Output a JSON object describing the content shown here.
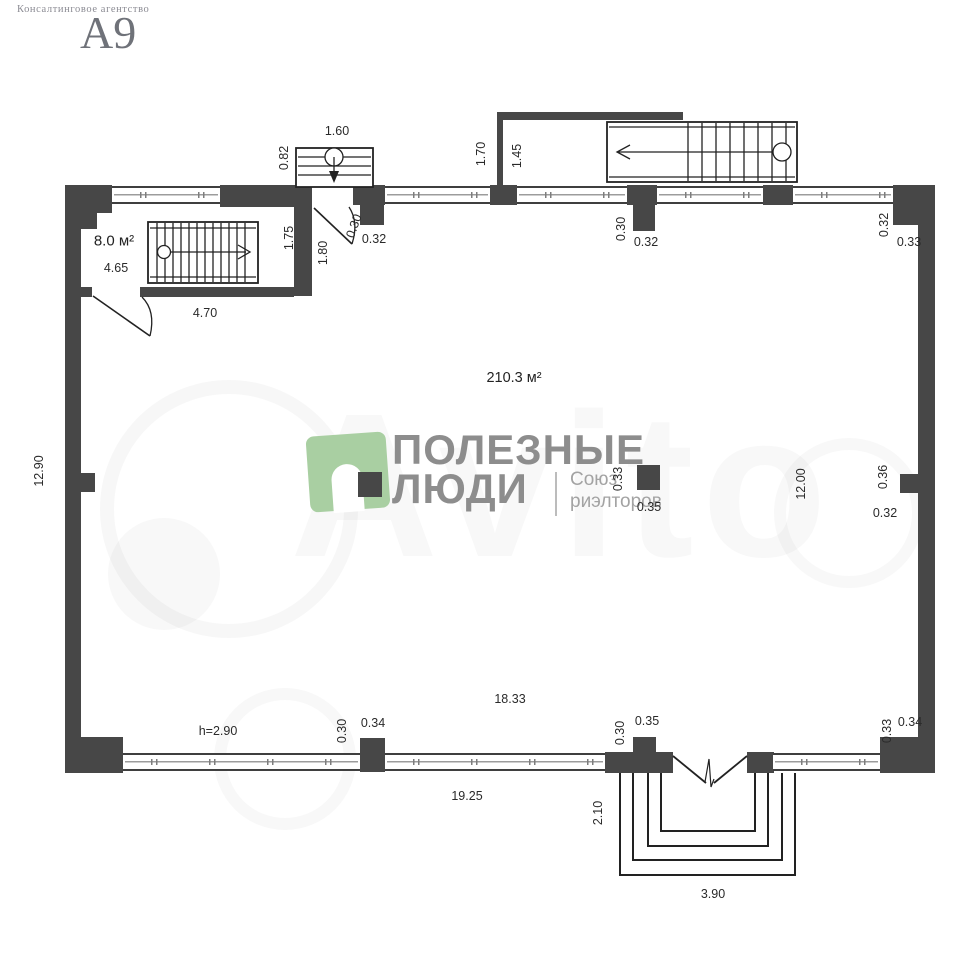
{
  "header": {
    "agency": "Консалтинговое агентство",
    "agency_code": "А9"
  },
  "watermark": {
    "text": "Avito"
  },
  "logo": {
    "title_line1": "ПОЛЕЗНЫЕ",
    "title_line2": "ЛЮДИ",
    "subtitle_line1": "Союз",
    "subtitle_line2": "риэлторов",
    "green": "#a9cfa2",
    "text_color": "#8d8d8d"
  },
  "plan": {
    "total_area": "210.3 м²",
    "room_area": "8.0 м²",
    "colors": {
      "wall": "#474747",
      "line": "#222222"
    },
    "dimensions": [
      {
        "id": "d01",
        "text": "1.60"
      },
      {
        "id": "d02",
        "text": "0.82"
      },
      {
        "id": "d03",
        "text": "1.70"
      },
      {
        "id": "d04",
        "text": "1.45"
      },
      {
        "id": "d05",
        "text": "0.30"
      },
      {
        "id": "d06",
        "text": "0.32"
      },
      {
        "id": "d07",
        "text": "0.30"
      },
      {
        "id": "d08",
        "text": "0.32"
      },
      {
        "id": "d09",
        "text": "0.32"
      },
      {
        "id": "d10",
        "text": "0.33"
      },
      {
        "id": "d11",
        "text": "4.65"
      },
      {
        "id": "d12",
        "text": "4.70"
      },
      {
        "id": "d13",
        "text": "1.75"
      },
      {
        "id": "d14",
        "text": "1.80"
      },
      {
        "id": "d15",
        "text": "12.90"
      },
      {
        "id": "d16",
        "text": "12.00"
      },
      {
        "id": "d17",
        "text": "0.36"
      },
      {
        "id": "d18",
        "text": "0.32"
      },
      {
        "id": "d19",
        "text": "0.33"
      },
      {
        "id": "d20",
        "text": "0.35"
      },
      {
        "id": "d21",
        "text": "h=2.90"
      },
      {
        "id": "d22",
        "text": "0.30"
      },
      {
        "id": "d23",
        "text": "0.34"
      },
      {
        "id": "d24",
        "text": "18.33"
      },
      {
        "id": "d25",
        "text": "0.30"
      },
      {
        "id": "d26",
        "text": "0.35"
      },
      {
        "id": "d27",
        "text": "0.33"
      },
      {
        "id": "d28",
        "text": "0.34"
      },
      {
        "id": "d29",
        "text": "19.25"
      },
      {
        "id": "d30",
        "text": "2.10"
      },
      {
        "id": "d31",
        "text": "3.90"
      }
    ]
  }
}
